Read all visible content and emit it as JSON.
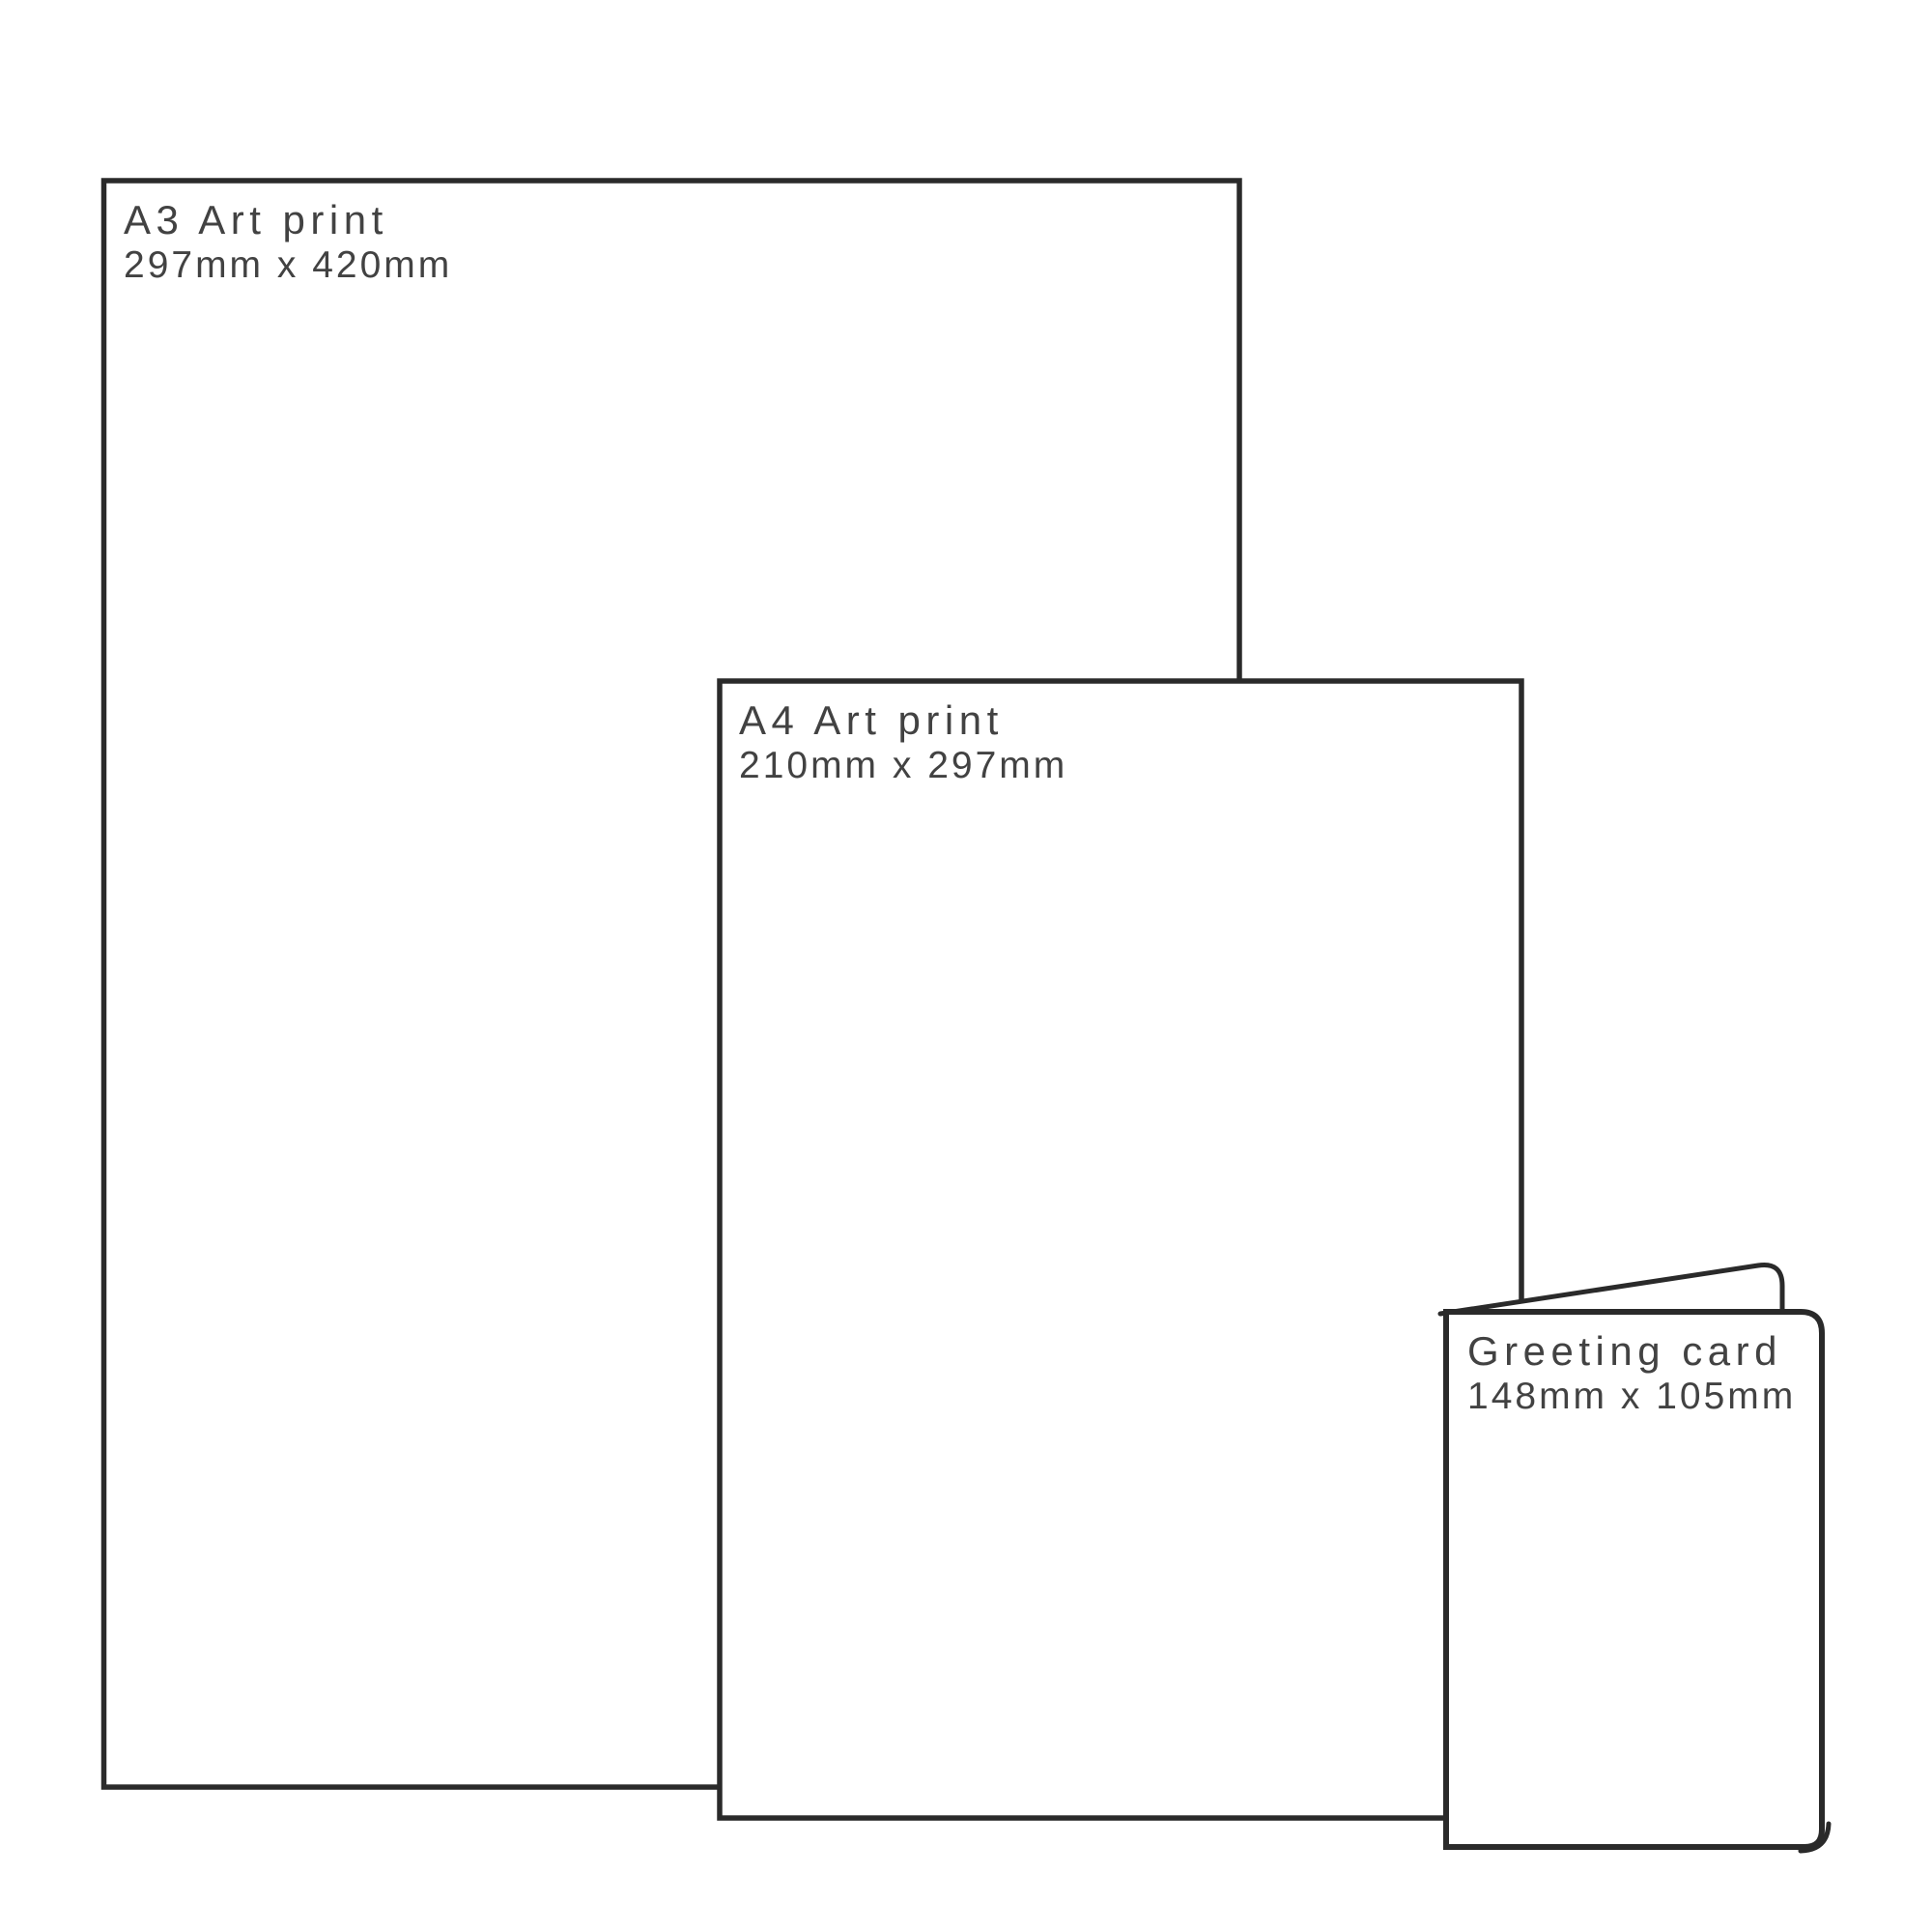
{
  "diagram": {
    "description": "Print size comparison diagram",
    "items": [
      {
        "name": "a3-art-print",
        "title": "A3 Art print",
        "dimensions": "297mm x 420mm"
      },
      {
        "name": "a4-art-print",
        "title": "A4 Art print",
        "dimensions": "210mm x 297mm"
      },
      {
        "name": "greeting-card",
        "title": "Greeting card",
        "dimensions": "148mm x 105mm"
      }
    ]
  },
  "colors": {
    "background": "#ffffff",
    "outline": "#2a2a2a",
    "label_text": "#424242"
  }
}
